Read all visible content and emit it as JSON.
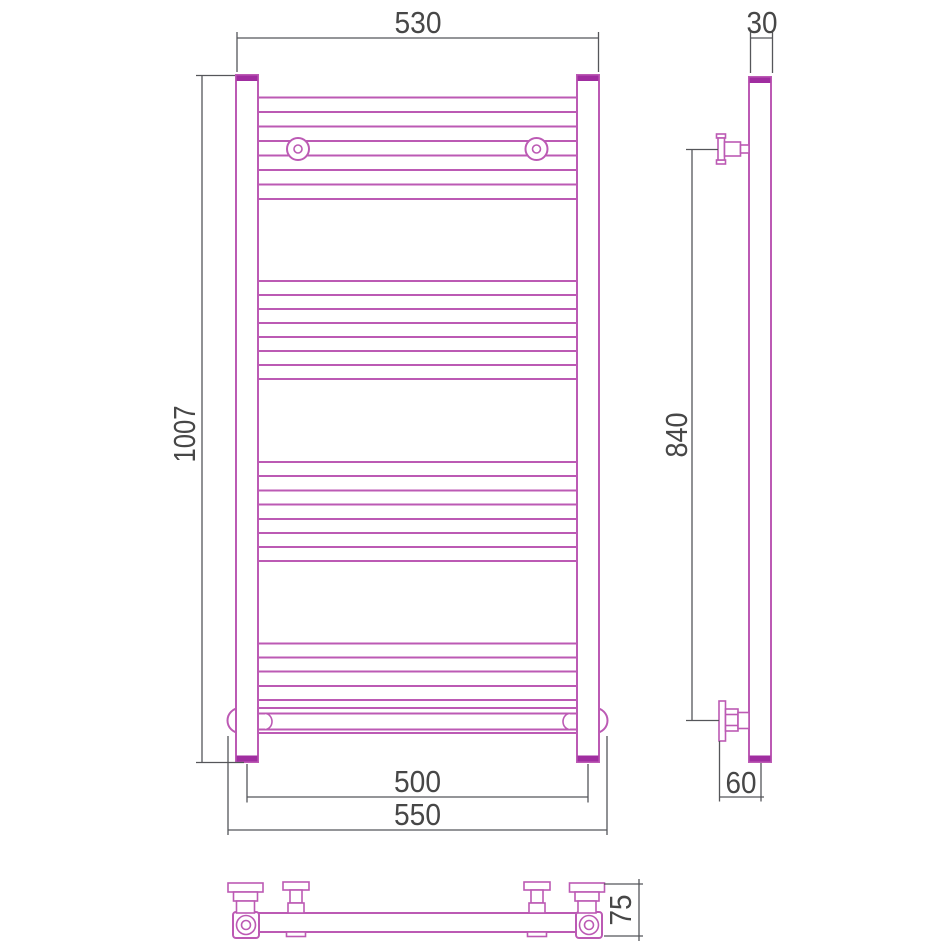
{
  "title": "towel-radiator-technical-drawing",
  "colors": {
    "outline": "#bc5ab4",
    "outline_dark": "#a02da0",
    "dimension": "#55565a",
    "label": "#474747",
    "background": "#ffffff"
  },
  "front_view": {
    "label_width_top": "530",
    "label_height": "1007",
    "label_width_centers": "500",
    "label_width_overall": "550"
  },
  "side_view": {
    "label_depth_top": "30",
    "label_mount_height": "840",
    "label_offset_bottom": "60"
  },
  "bottom_view": {
    "label_depth": "75"
  }
}
